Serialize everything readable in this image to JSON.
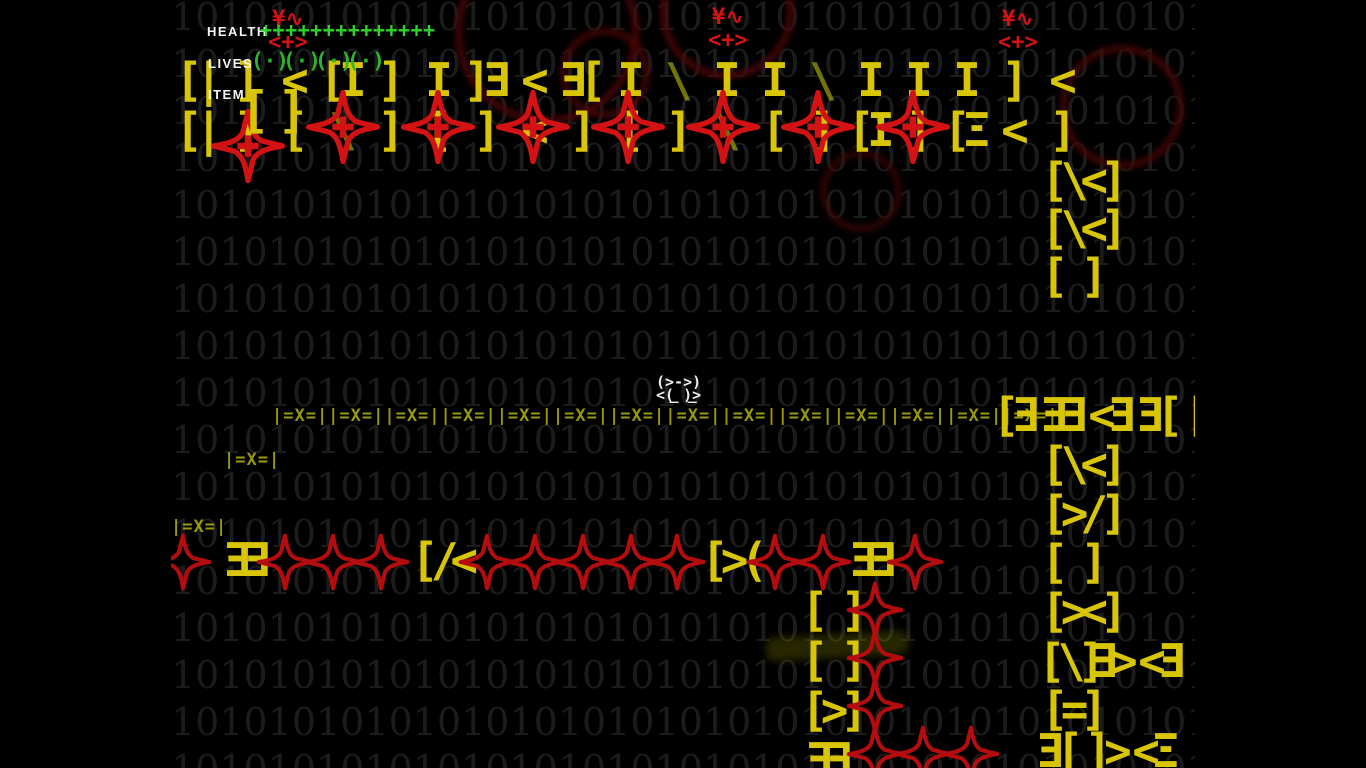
{
  "layout": {
    "game_area_left": 171,
    "game_area_width": 1024,
    "screen_width": 1366,
    "screen_height": 768,
    "tile_size": 48
  },
  "colors": {
    "background": "#000000",
    "binary_text": "#1c1c1c",
    "tile_yellow": "#d8c505",
    "dim_olive": "#9a9a08",
    "enemy_red": "#d31313",
    "chain_red": "#b50d0d",
    "health_green": "#2fd32f",
    "lives_green": "#2ab82a",
    "hud_white": "#f4f4f4",
    "player_white": "#ededed"
  },
  "background": {
    "pattern": "10",
    "repeats": 23,
    "rows": 17,
    "row_height": 47,
    "start_y": -6
  },
  "hud": {
    "health_label": "HEALTH",
    "health_symbol": "+",
    "health_units": 14,
    "health_pos": {
      "x": 207,
      "y": 24,
      "units_x": 260,
      "units_y": 18
    },
    "lives_label": "LIVES",
    "life_symbol": "(·)",
    "lives_units": 4,
    "lives_pos": {
      "x": 208,
      "y": 56,
      "units_x": 251,
      "units_y": 49,
      "spacing": 32
    },
    "item_label": "ITEM",
    "item_symbol": "[]",
    "item_pos": {
      "x": 208,
      "y": 87,
      "glyph_x": 240,
      "glyph_y": 82
    }
  },
  "player": {
    "x": 656,
    "y": 361,
    "lines": [
      "(>->)",
      "<( )>",
      " ‾ ‾"
    ]
  },
  "virus_glyph": {
    "line1": "¥∿",
    "line2": "<+>"
  },
  "viruses": [
    {
      "x": 268,
      "y": 8
    },
    {
      "x": 708,
      "y": 6
    },
    {
      "x": 998,
      "y": 8
    }
  ],
  "tiles": [
    {
      "x": 171,
      "y": 56,
      "t": "[|"
    },
    {
      "x": 219,
      "y": 56,
      "t": "]"
    },
    {
      "x": 267,
      "y": 56,
      "t": "<"
    },
    {
      "x": 315,
      "y": 56,
      "t": "[I"
    },
    {
      "x": 363,
      "y": 56,
      "t": "]"
    },
    {
      "x": 411,
      "y": 56,
      "t": "I"
    },
    {
      "x": 459,
      "y": 56,
      "t": "]Ǝ"
    },
    {
      "x": 507,
      "y": 56,
      "t": "<"
    },
    {
      "x": 555,
      "y": 56,
      "t": "Ǝ["
    },
    {
      "x": 603,
      "y": 56,
      "t": "I"
    },
    {
      "x": 651,
      "y": 56,
      "t": "\\",
      "k": "dim"
    },
    {
      "x": 699,
      "y": 56,
      "t": "I"
    },
    {
      "x": 747,
      "y": 56,
      "t": "I"
    },
    {
      "x": 795,
      "y": 56,
      "t": "\\",
      "k": "dim"
    },
    {
      "x": 843,
      "y": 56,
      "t": "I"
    },
    {
      "x": 891,
      "y": 56,
      "t": "I"
    },
    {
      "x": 939,
      "y": 56,
      "t": "I"
    },
    {
      "x": 987,
      "y": 56,
      "t": "]"
    },
    {
      "x": 1035,
      "y": 56,
      "t": "<"
    },
    {
      "x": 171,
      "y": 106,
      "t": "[|"
    },
    {
      "x": 219,
      "y": 106,
      "t": "]"
    },
    {
      "x": 267,
      "y": 106,
      "t": "["
    },
    {
      "x": 315,
      "y": 106,
      "t": "\\",
      "k": "dim"
    },
    {
      "x": 363,
      "y": 106,
      "t": "]"
    },
    {
      "x": 411,
      "y": 106,
      "t": "["
    },
    {
      "x": 459,
      "y": 106,
      "t": "]"
    },
    {
      "x": 507,
      "y": 106,
      "t": "<"
    },
    {
      "x": 555,
      "y": 106,
      "t": "]"
    },
    {
      "x": 603,
      "y": 106,
      "t": "["
    },
    {
      "x": 651,
      "y": 106,
      "t": "]"
    },
    {
      "x": 699,
      "y": 106,
      "t": "\\",
      "k": "dim"
    },
    {
      "x": 747,
      "y": 106,
      "t": "["
    },
    {
      "x": 795,
      "y": 106,
      "t": "]"
    },
    {
      "x": 843,
      "y": 106,
      "t": "[I"
    },
    {
      "x": 891,
      "y": 106,
      "t": "]"
    },
    {
      "x": 939,
      "y": 106,
      "t": "[Ξ"
    },
    {
      "x": 987,
      "y": 106,
      "t": "<"
    },
    {
      "x": 1035,
      "y": 106,
      "t": "]"
    },
    {
      "x": 1041,
      "y": 156,
      "t": "[\\<]"
    },
    {
      "x": 1041,
      "y": 204,
      "t": "[\\<]"
    },
    {
      "x": 1041,
      "y": 252,
      "t": "[ ]"
    },
    {
      "x": 988,
      "y": 391,
      "t": "[Ǝ"
    },
    {
      "x": 1036,
      "y": 391,
      "t": "ƎƎ"
    },
    {
      "x": 1084,
      "y": 391,
      "t": "<Ǝ"
    },
    {
      "x": 1132,
      "y": 391,
      "t": "Ǝ["
    },
    {
      "x": 1180,
      "y": 391,
      "t": "[("
    },
    {
      "x": 1041,
      "y": 440,
      "t": "[\\<]"
    },
    {
      "x": 1041,
      "y": 489,
      "t": "[>/]"
    },
    {
      "x": 1041,
      "y": 538,
      "t": "[ ]"
    },
    {
      "x": 1041,
      "y": 587,
      "t": "[><]"
    },
    {
      "x": 1041,
      "y": 685,
      "t": "[=]"
    },
    {
      "x": 1038,
      "y": 637,
      "t": "[\\]"
    },
    {
      "x": 1086,
      "y": 637,
      "t": "Ǝ>"
    },
    {
      "x": 1134,
      "y": 637,
      "t": "<Ǝ"
    },
    {
      "x": 1182,
      "y": 637,
      "t": "["
    },
    {
      "x": 1184,
      "y": 592,
      "t": "["
    },
    {
      "x": 1032,
      "y": 727,
      "t": "Ǝ["
    },
    {
      "x": 1080,
      "y": 727,
      "t": "]>"
    },
    {
      "x": 1128,
      "y": 727,
      "t": "<Ξ"
    },
    {
      "x": 1176,
      "y": 727,
      "t": "["
    },
    {
      "x": 219,
      "y": 536,
      "t": "ƎƎ"
    },
    {
      "x": 411,
      "y": 536,
      "t": "[/<"
    },
    {
      "x": 701,
      "y": 536,
      "t": "[>("
    },
    {
      "x": 845,
      "y": 536,
      "t": "ƎƎ"
    },
    {
      "x": 801,
      "y": 586,
      "t": "[ ]"
    },
    {
      "x": 801,
      "y": 636,
      "t": "[ ]"
    },
    {
      "x": 801,
      "y": 686,
      "t": "[>]"
    },
    {
      "x": 801,
      "y": 736,
      "t": "ƎƎ"
    }
  ],
  "dim_platforms": [
    {
      "x": 272,
      "y": 408,
      "unit": "|=X=|",
      "count": 14
    },
    {
      "x": 224,
      "y": 452,
      "unit": "|=X=|",
      "count": 1
    },
    {
      "x": 171,
      "y": 519,
      "unit": "|=X=|",
      "count": 1
    }
  ],
  "stars": {
    "plus_size": 76,
    "chain_size": 58,
    "plus": [
      {
        "x": 248,
        "y": 146
      },
      {
        "x": 343,
        "y": 127
      },
      {
        "x": 438,
        "y": 127
      },
      {
        "x": 533,
        "y": 127
      },
      {
        "x": 628,
        "y": 127
      },
      {
        "x": 723,
        "y": 127
      },
      {
        "x": 818,
        "y": 127
      },
      {
        "x": 913,
        "y": 127
      }
    ],
    "chain": [
      {
        "x": 183,
        "y": 562
      },
      {
        "x": 285,
        "y": 562
      },
      {
        "x": 333,
        "y": 562
      },
      {
        "x": 381,
        "y": 562
      },
      {
        "x": 487,
        "y": 562
      },
      {
        "x": 535,
        "y": 562
      },
      {
        "x": 583,
        "y": 562
      },
      {
        "x": 631,
        "y": 562
      },
      {
        "x": 677,
        "y": 562
      },
      {
        "x": 775,
        "y": 562
      },
      {
        "x": 823,
        "y": 562
      },
      {
        "x": 915,
        "y": 562
      },
      {
        "x": 875,
        "y": 610
      },
      {
        "x": 875,
        "y": 658
      },
      {
        "x": 875,
        "y": 706
      },
      {
        "x": 875,
        "y": 754
      },
      {
        "x": 923,
        "y": 754
      },
      {
        "x": 971,
        "y": 754
      }
    ]
  },
  "decor": {
    "swirls": [
      {
        "x": 455,
        "y": -60,
        "r": 85,
        "c": "#4a0707",
        "o": 0.9
      },
      {
        "x": 660,
        "y": -55,
        "r": 60,
        "c": "#4a0707",
        "o": 0.9
      },
      {
        "x": 1060,
        "y": 45,
        "r": 55,
        "c": "#430606",
        "o": 0.9
      },
      {
        "x": 560,
        "y": 28,
        "r": 38,
        "c": "#4a0606",
        "o": 0.8
      },
      {
        "x": 820,
        "y": 150,
        "r": 34,
        "c": "#400707",
        "o": 0.7
      }
    ],
    "streak": {
      "x": 766,
      "y": 634,
      "w": 142,
      "h": 24,
      "c": "#8a8a00",
      "o": 0.28
    }
  }
}
